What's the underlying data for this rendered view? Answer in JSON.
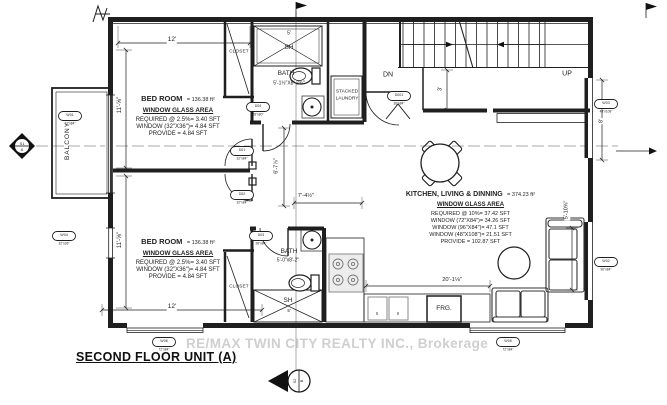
{
  "title": "SECOND FLOOR UNIT (A)",
  "watermark": "RE/MAX TWIN CITY REALTY INC., Brokerage",
  "rooms": {
    "bedroom1": {
      "name": "BED ROOM",
      "area": "= 136.38 ft²",
      "glass": "WINDOW GLASS AREA",
      "req": "REQUIRED @ 2.5%= 3.40 SFT",
      "win": "WINDOW (32\"X36\")= 4.84 SFT",
      "prov": "PROVIDE = 4.84 SFT"
    },
    "bedroom2": {
      "name": "BED ROOM",
      "area": "= 136.38 ft²",
      "glass": "WINDOW GLASS AREA",
      "req": "REQUIRED @ 2.5%= 3.40 SFT",
      "win": "WINDOW (32\"X36\")= 4.84 SFT",
      "prov": "PROVIDE = 4.84 SFT"
    },
    "kitchen": {
      "name": "KITCHEN, LIVING & DINNING",
      "area": "= 374.23 ft²",
      "glass": "WINDOW GLASS AREA",
      "req": "REQUIRED @ 10%= 37.42 SFT",
      "win1": "WINDOW (72\"X84\")= 34.26 SFT",
      "win2": "WINDOW (96\"X84\")= 47.1 SFT",
      "win3": "WINDOW (48\"X108\")= 21.51 SFT",
      "prov": "PROVIDE = 102.87 SFT"
    },
    "bath1": {
      "name": "BATH",
      "size": "5'-1½\"X8'-2¾\""
    },
    "bath2": {
      "name": "BATH",
      "size": "5'-0\"x8'-2\""
    },
    "balcony": "BALCONY",
    "closet1": "CLOSET",
    "closet2": "CLOSET",
    "laundry1": "STACKED",
    "laundry2": "LAUNDRY",
    "fridge": "FRG.",
    "shower1": "SH",
    "shower2": "SH"
  },
  "stairs": {
    "dn": "DN",
    "up": "UP"
  },
  "dims": {
    "top": "12'",
    "bottom": "12'",
    "left_top": "11'-⅝\"",
    "left_bottom": "11'-⅝\"",
    "hall": "7'-4½\"",
    "kitchen": "20'-1⅛\"",
    "doorway": "6'-7⅞\"",
    "stair": "3'",
    "right": "8'",
    "sofa": "5'-10⅝\"",
    "shower1": "5'",
    "shower2": "5'"
  },
  "tags": {
    "w01": {
      "id": "W01",
      "size": "72\"x84\""
    },
    "w02": {
      "id": "W02",
      "size": "96\"x84\""
    },
    "w03": {
      "id": "W03",
      "size": "48\"x108\""
    },
    "w04": {
      "id": "W04",
      "size": "32\"x36\""
    },
    "w05": {
      "id": "W05",
      "size": "72\"x84\""
    },
    "w06": {
      "id": "W06",
      "size": "72\"x84\""
    },
    "d001": {
      "id": "D001",
      "size": "36\"x84\""
    },
    "d01": {
      "id": "D01",
      "size": "32\"x84\""
    },
    "d02": {
      "id": "D02",
      "size": "32\"x84\""
    },
    "d03": {
      "id": "D03",
      "size": "28\"x84\""
    },
    "d04": {
      "id": "D04",
      "size": "28\"x80\""
    }
  },
  "markers": {
    "section1_top": "S1",
    "section1_bot": "A",
    "section2_top": "S2",
    "section2_bot": "B"
  }
}
